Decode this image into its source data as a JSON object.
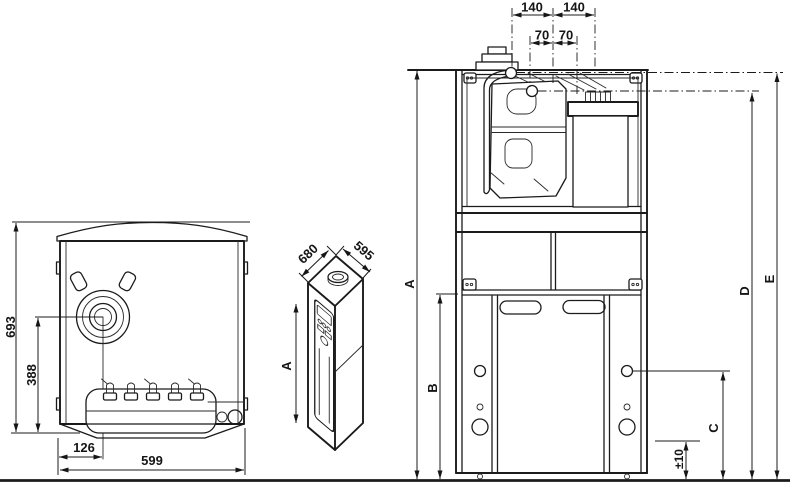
{
  "drawing": {
    "front_view": {
      "overall_height": "693",
      "burner_axis_height": "388",
      "burner_axis_offset": "126",
      "overall_width": "599"
    },
    "iso_view": {
      "depth": "680",
      "width": "595",
      "height_label": "A"
    },
    "installation_view": {
      "flue_offset_left": "140",
      "flue_offset_right": "140",
      "connection_offset_left": "70",
      "connection_offset_right": "70",
      "label_a": "A",
      "label_b": "B",
      "label_c": "C",
      "label_d": "D",
      "label_e": "E",
      "foot_adjustment": "±10"
    }
  }
}
